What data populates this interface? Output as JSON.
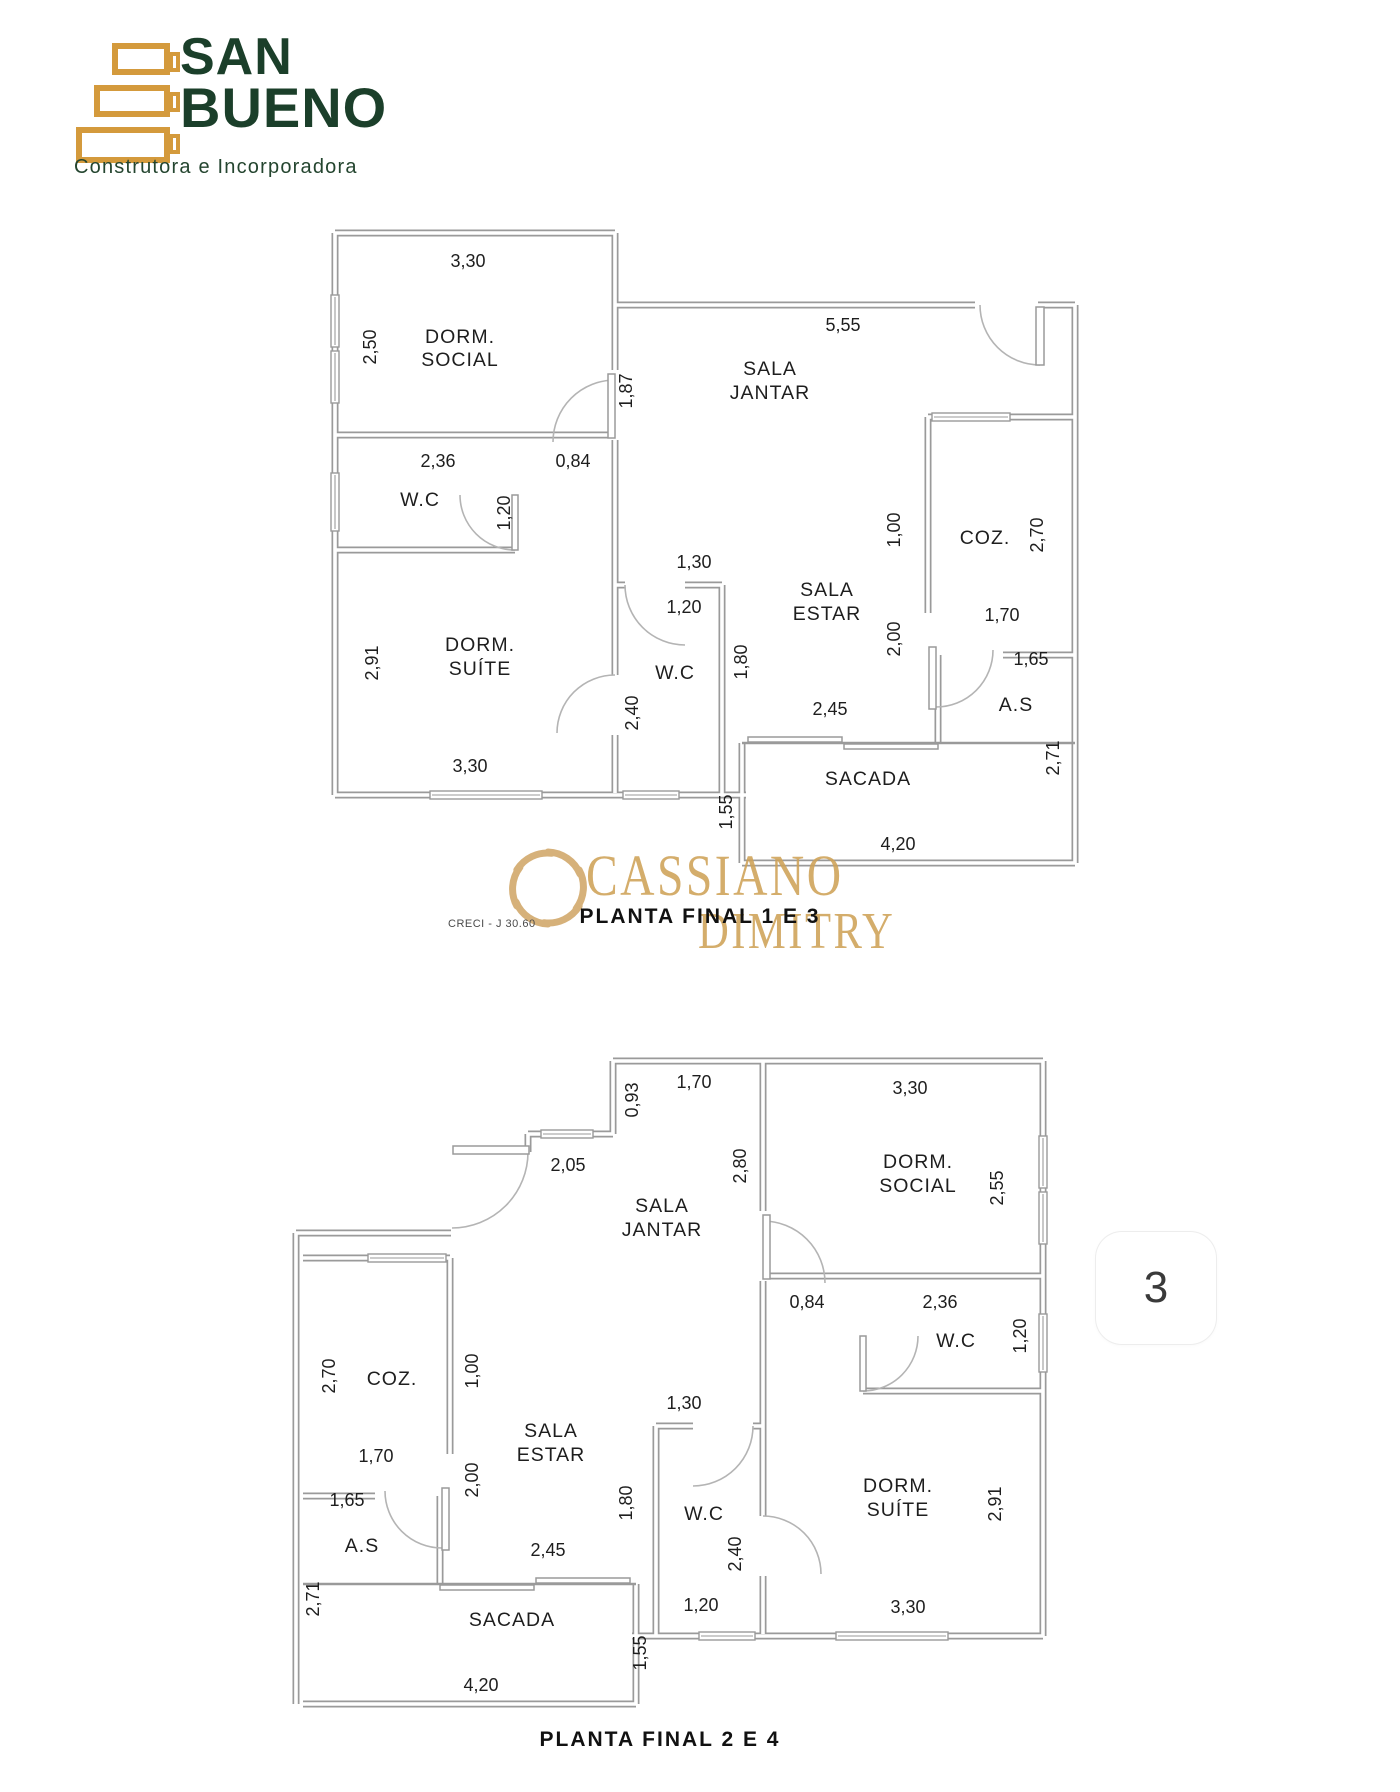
{
  "logo": {
    "name_line1": "SAN",
    "name_line2": "BUENO",
    "tagline": "Construtora e Incorporadora",
    "gold": "#d49a3c",
    "green": "#1b3f2a"
  },
  "watermark": {
    "brand_top": "CASSIANO",
    "brand_bottom": "DIMITRY",
    "creci": "CRECI - J 30.60",
    "color": "#cfa257"
  },
  "page_marker": {
    "number": "3"
  },
  "plans": [
    {
      "caption": "PLANTA FINAL 1 E 3",
      "labels": [
        {
          "t": "3,30",
          "x": 148,
          "y": 72
        },
        {
          "t": "2,50",
          "x": 56,
          "y": 152,
          "r": 1
        },
        {
          "t": "DORM.",
          "x": 140,
          "y": 148,
          "room": 1
        },
        {
          "t": "SOCIAL",
          "x": 140,
          "y": 171,
          "room": 1
        },
        {
          "t": "2,36",
          "x": 118,
          "y": 272
        },
        {
          "t": "W.C",
          "x": 100,
          "y": 311,
          "room": 1
        },
        {
          "t": "1,20",
          "x": 190,
          "y": 318,
          "r": 1
        },
        {
          "t": "0,84",
          "x": 253,
          "y": 272
        },
        {
          "t": "5,55",
          "x": 523,
          "y": 136
        },
        {
          "t": "1,87",
          "x": 312,
          "y": 196,
          "r": 1
        },
        {
          "t": "SALA",
          "x": 450,
          "y": 180,
          "room": 1
        },
        {
          "t": "JANTAR",
          "x": 450,
          "y": 204,
          "room": 1
        },
        {
          "t": "1,00",
          "x": 580,
          "y": 335,
          "r": 1
        },
        {
          "t": "2,00",
          "x": 580,
          "y": 444,
          "r": 1
        },
        {
          "t": "COZ.",
          "x": 665,
          "y": 349,
          "room": 1
        },
        {
          "t": "2,70",
          "x": 723,
          "y": 340,
          "r": 1
        },
        {
          "t": "1,70",
          "x": 682,
          "y": 426
        },
        {
          "t": "1,65",
          "x": 711,
          "y": 470
        },
        {
          "t": "A.S",
          "x": 696,
          "y": 516,
          "room": 1
        },
        {
          "t": "2,91",
          "x": 58,
          "y": 468,
          "r": 1
        },
        {
          "t": "DORM.",
          "x": 160,
          "y": 456,
          "room": 1
        },
        {
          "t": "SUÍTE",
          "x": 160,
          "y": 480,
          "room": 1
        },
        {
          "t": "3,30",
          "x": 150,
          "y": 577
        },
        {
          "t": "1,30",
          "x": 374,
          "y": 373
        },
        {
          "t": "1,20",
          "x": 364,
          "y": 418
        },
        {
          "t": "W.C",
          "x": 355,
          "y": 484,
          "room": 1
        },
        {
          "t": "2,40",
          "x": 318,
          "y": 518,
          "r": 1
        },
        {
          "t": "1,80",
          "x": 427,
          "y": 467,
          "r": 1
        },
        {
          "t": "SALA",
          "x": 507,
          "y": 401,
          "room": 1
        },
        {
          "t": "ESTAR",
          "x": 507,
          "y": 425,
          "room": 1
        },
        {
          "t": "2,45",
          "x": 510,
          "y": 520
        },
        {
          "t": "SACADA",
          "x": 548,
          "y": 590,
          "room": 1
        },
        {
          "t": "1,55",
          "x": 412,
          "y": 617,
          "r": 1
        },
        {
          "t": "2,71",
          "x": 739,
          "y": 563,
          "r": 1
        },
        {
          "t": "4,20",
          "x": 578,
          "y": 655
        }
      ]
    },
    {
      "caption": "PLANTA FINAL 2 E 4",
      "labels": [
        {
          "t": "0,93",
          "x": 350,
          "y": 64,
          "r": 1
        },
        {
          "t": "1,70",
          "x": 406,
          "y": 52
        },
        {
          "t": "2,05",
          "x": 280,
          "y": 135
        },
        {
          "t": "SALA",
          "x": 374,
          "y": 176,
          "room": 1
        },
        {
          "t": "JANTAR",
          "x": 374,
          "y": 200,
          "room": 1
        },
        {
          "t": "2,80",
          "x": 458,
          "y": 130,
          "r": 1
        },
        {
          "t": "3,30",
          "x": 622,
          "y": 58
        },
        {
          "t": "DORM.",
          "x": 630,
          "y": 132,
          "room": 1
        },
        {
          "t": "SOCIAL",
          "x": 630,
          "y": 156,
          "room": 1
        },
        {
          "t": "2,55",
          "x": 715,
          "y": 152,
          "r": 1
        },
        {
          "t": "0,84",
          "x": 519,
          "y": 272
        },
        {
          "t": "2,36",
          "x": 652,
          "y": 272
        },
        {
          "t": "W.C",
          "x": 668,
          "y": 311,
          "room": 1
        },
        {
          "t": "1,20",
          "x": 738,
          "y": 300,
          "r": 1
        },
        {
          "t": "2,70",
          "x": 47,
          "y": 340,
          "r": 1
        },
        {
          "t": "COZ.",
          "x": 104,
          "y": 349,
          "room": 1
        },
        {
          "t": "1,00",
          "x": 190,
          "y": 335,
          "r": 1
        },
        {
          "t": "1,70",
          "x": 88,
          "y": 426
        },
        {
          "t": "1,65",
          "x": 59,
          "y": 470
        },
        {
          "t": "A.S",
          "x": 74,
          "y": 516,
          "room": 1
        },
        {
          "t": "2,00",
          "x": 190,
          "y": 444,
          "r": 1
        },
        {
          "t": "SALA",
          "x": 263,
          "y": 401,
          "room": 1
        },
        {
          "t": "ESTAR",
          "x": 263,
          "y": 425,
          "room": 1
        },
        {
          "t": "1,30",
          "x": 396,
          "y": 373
        },
        {
          "t": "1,80",
          "x": 344,
          "y": 467,
          "r": 1
        },
        {
          "t": "W.C",
          "x": 416,
          "y": 484,
          "room": 1
        },
        {
          "t": "2,40",
          "x": 453,
          "y": 518,
          "r": 1
        },
        {
          "t": "1,20",
          "x": 413,
          "y": 575
        },
        {
          "t": "2,45",
          "x": 260,
          "y": 520
        },
        {
          "t": "DORM.",
          "x": 610,
          "y": 456,
          "room": 1
        },
        {
          "t": "SUÍTE",
          "x": 610,
          "y": 480,
          "room": 1
        },
        {
          "t": "2,91",
          "x": 713,
          "y": 468,
          "r": 1
        },
        {
          "t": "3,30",
          "x": 620,
          "y": 577
        },
        {
          "t": "2,71",
          "x": 31,
          "y": 563,
          "r": 1
        },
        {
          "t": "SACADA",
          "x": 224,
          "y": 590,
          "room": 1
        },
        {
          "t": "1,55",
          "x": 358,
          "y": 617,
          "r": 1
        },
        {
          "t": "4,20",
          "x": 193,
          "y": 655
        }
      ]
    }
  ]
}
